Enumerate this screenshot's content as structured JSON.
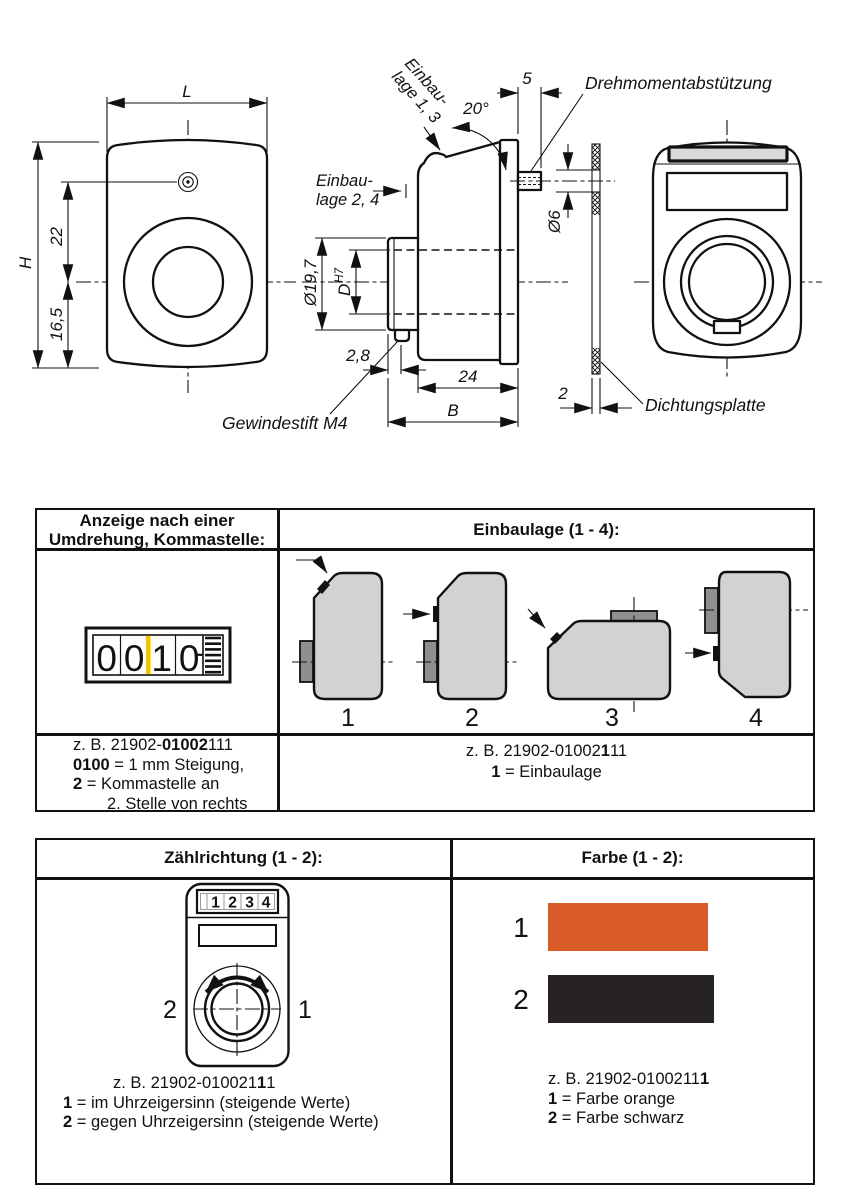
{
  "drawing": {
    "dim_L": "L",
    "dim_H": "H",
    "dim_22": "22",
    "dim_165": "16,5",
    "dim_phi197": "Ø19,7",
    "dim_D": "D",
    "dim_H7": "H7",
    "dim_28": "2,8",
    "dim_24": "24",
    "dim_B": "B",
    "dim_5": "5",
    "dim_20deg": "20°",
    "dim_phi6": "Ø6",
    "dim_2": "2",
    "label_einbaulage13_line1": "Einbau-",
    "label_einbaulage13_line2": "lage 1, 3",
    "label_einbaulage24_line1": "Einbau-",
    "label_einbaulage24_line2": "lage 2, 4",
    "label_drehmoment": "Drehmomentabstützung",
    "label_dichtungsplatte": "Dichtungsplatte",
    "label_gewindestift": "Gewindestift M4"
  },
  "table1": {
    "header_left_line1": "Anzeige nach einer",
    "header_left_line2": "Umdrehung, Kommastelle:",
    "header_right": "Einbaulage (1 - 4):",
    "counter": {
      "d1": "0",
      "d2": "0",
      "d3": "1",
      "d4": "0",
      "comma_color": "#f3c300"
    },
    "positions": {
      "n1": "1",
      "n2": "2",
      "n3": "3",
      "n4": "4"
    },
    "caption_left": {
      "l1a": "z. B. 21902-",
      "l1b": "01002",
      "l1c": "111",
      "l2a": "0100",
      "l2b": " = 1 mm Steigung,",
      "l3a": "2",
      "l3b": " = Kommastelle an",
      "l4": "2. Stelle von rechts"
    },
    "caption_right": {
      "l1a": "z. B. 21902-01002",
      "l1b": "1",
      "l1c": "11",
      "l2a": "1",
      "l2b": " = Einbaulage"
    }
  },
  "table2": {
    "header_left": "Zählrichtung (1 - 2):",
    "header_right": "Farbe (1 - 2):",
    "device": {
      "d1": "1",
      "d2": "2",
      "d3": "3",
      "d4": "4",
      "left_num": "2",
      "right_num": "1"
    },
    "caption_left": {
      "l1a": "z. B. 21902-010021",
      "l1b": "1",
      "l1c": "1",
      "l2a": "1",
      "l2b": " = im Uhrzeigersinn (steigende Werte)",
      "l3a": "2",
      "l3b": " = gegen Uhrzeigersinn (steigende Werte)"
    },
    "colors": {
      "n1": "1",
      "n2": "2",
      "orange_hex": "#d95c28",
      "black_hex": "#272325"
    },
    "caption_right": {
      "l1a": "z. B. 21902-0100211",
      "l1b": "1",
      "l2a": "1",
      "l2b": " = Farbe orange",
      "l3a": "2",
      "l3b": " = Farbe schwarz"
    }
  }
}
